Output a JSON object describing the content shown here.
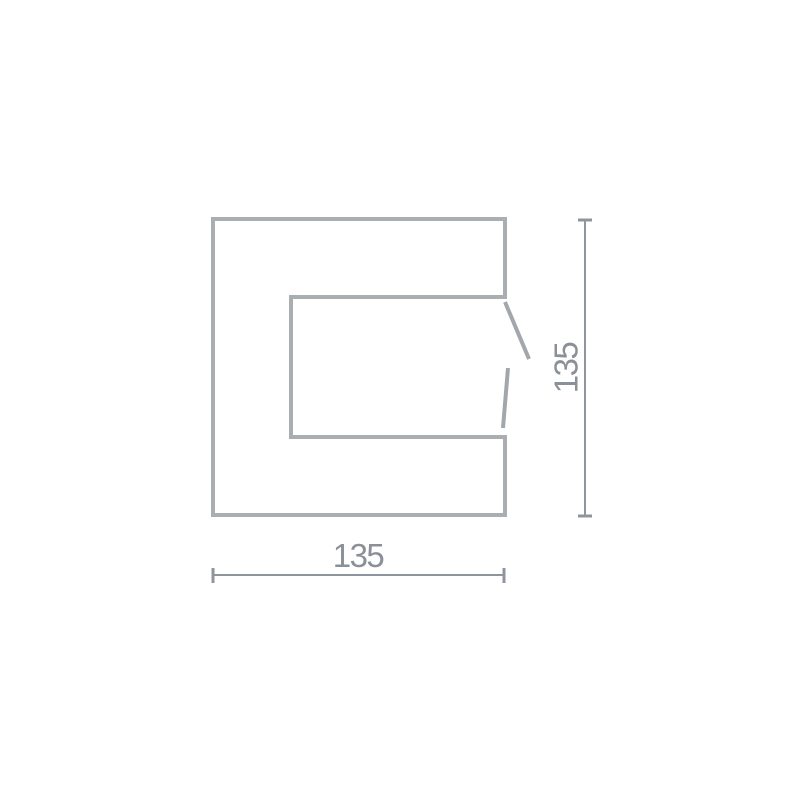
{
  "diagram": {
    "kind": "technical-dimension-drawing",
    "shape": "c-profile-with-break-marks",
    "width_label": "135",
    "height_label": "135",
    "width_value": 135,
    "height_value": 135
  },
  "colors": {
    "background": "#ffffff",
    "outline": "#a9aeb3",
    "break_mark": "#a2a7ad",
    "dimension_line": "#8f959c",
    "label_text": "#8a9097"
  }
}
